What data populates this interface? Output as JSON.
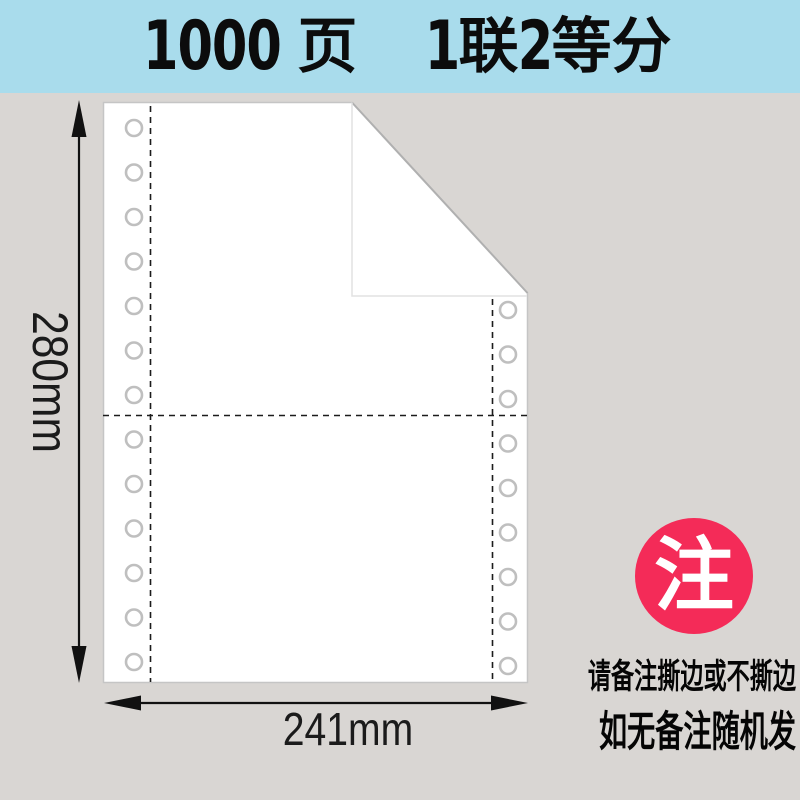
{
  "header": {
    "full_title": "1000页 1联2等分",
    "background_color": "#a9dcec",
    "segments": [
      {
        "text": "1000"
      },
      {
        "text": "页"
      },
      {
        "text": "1"
      },
      {
        "text": "联"
      },
      {
        "text": "2"
      },
      {
        "text": "等分"
      }
    ]
  },
  "diagram": {
    "background_color": "#d9d6d3",
    "paper_color": "#ffffff",
    "dimensions": {
      "height_label": "280mm",
      "width_label": "241mm"
    },
    "features": {
      "left_sprocket_holes": 13,
      "right_sprocket_holes": 9,
      "perforation_lines": "dashed",
      "folded_corner": "top-right"
    }
  },
  "note": {
    "badge_text": "注",
    "badge_color": "#f42b58",
    "line1": "请备注撕边或不撕边",
    "line2": "如无备注随机发"
  }
}
